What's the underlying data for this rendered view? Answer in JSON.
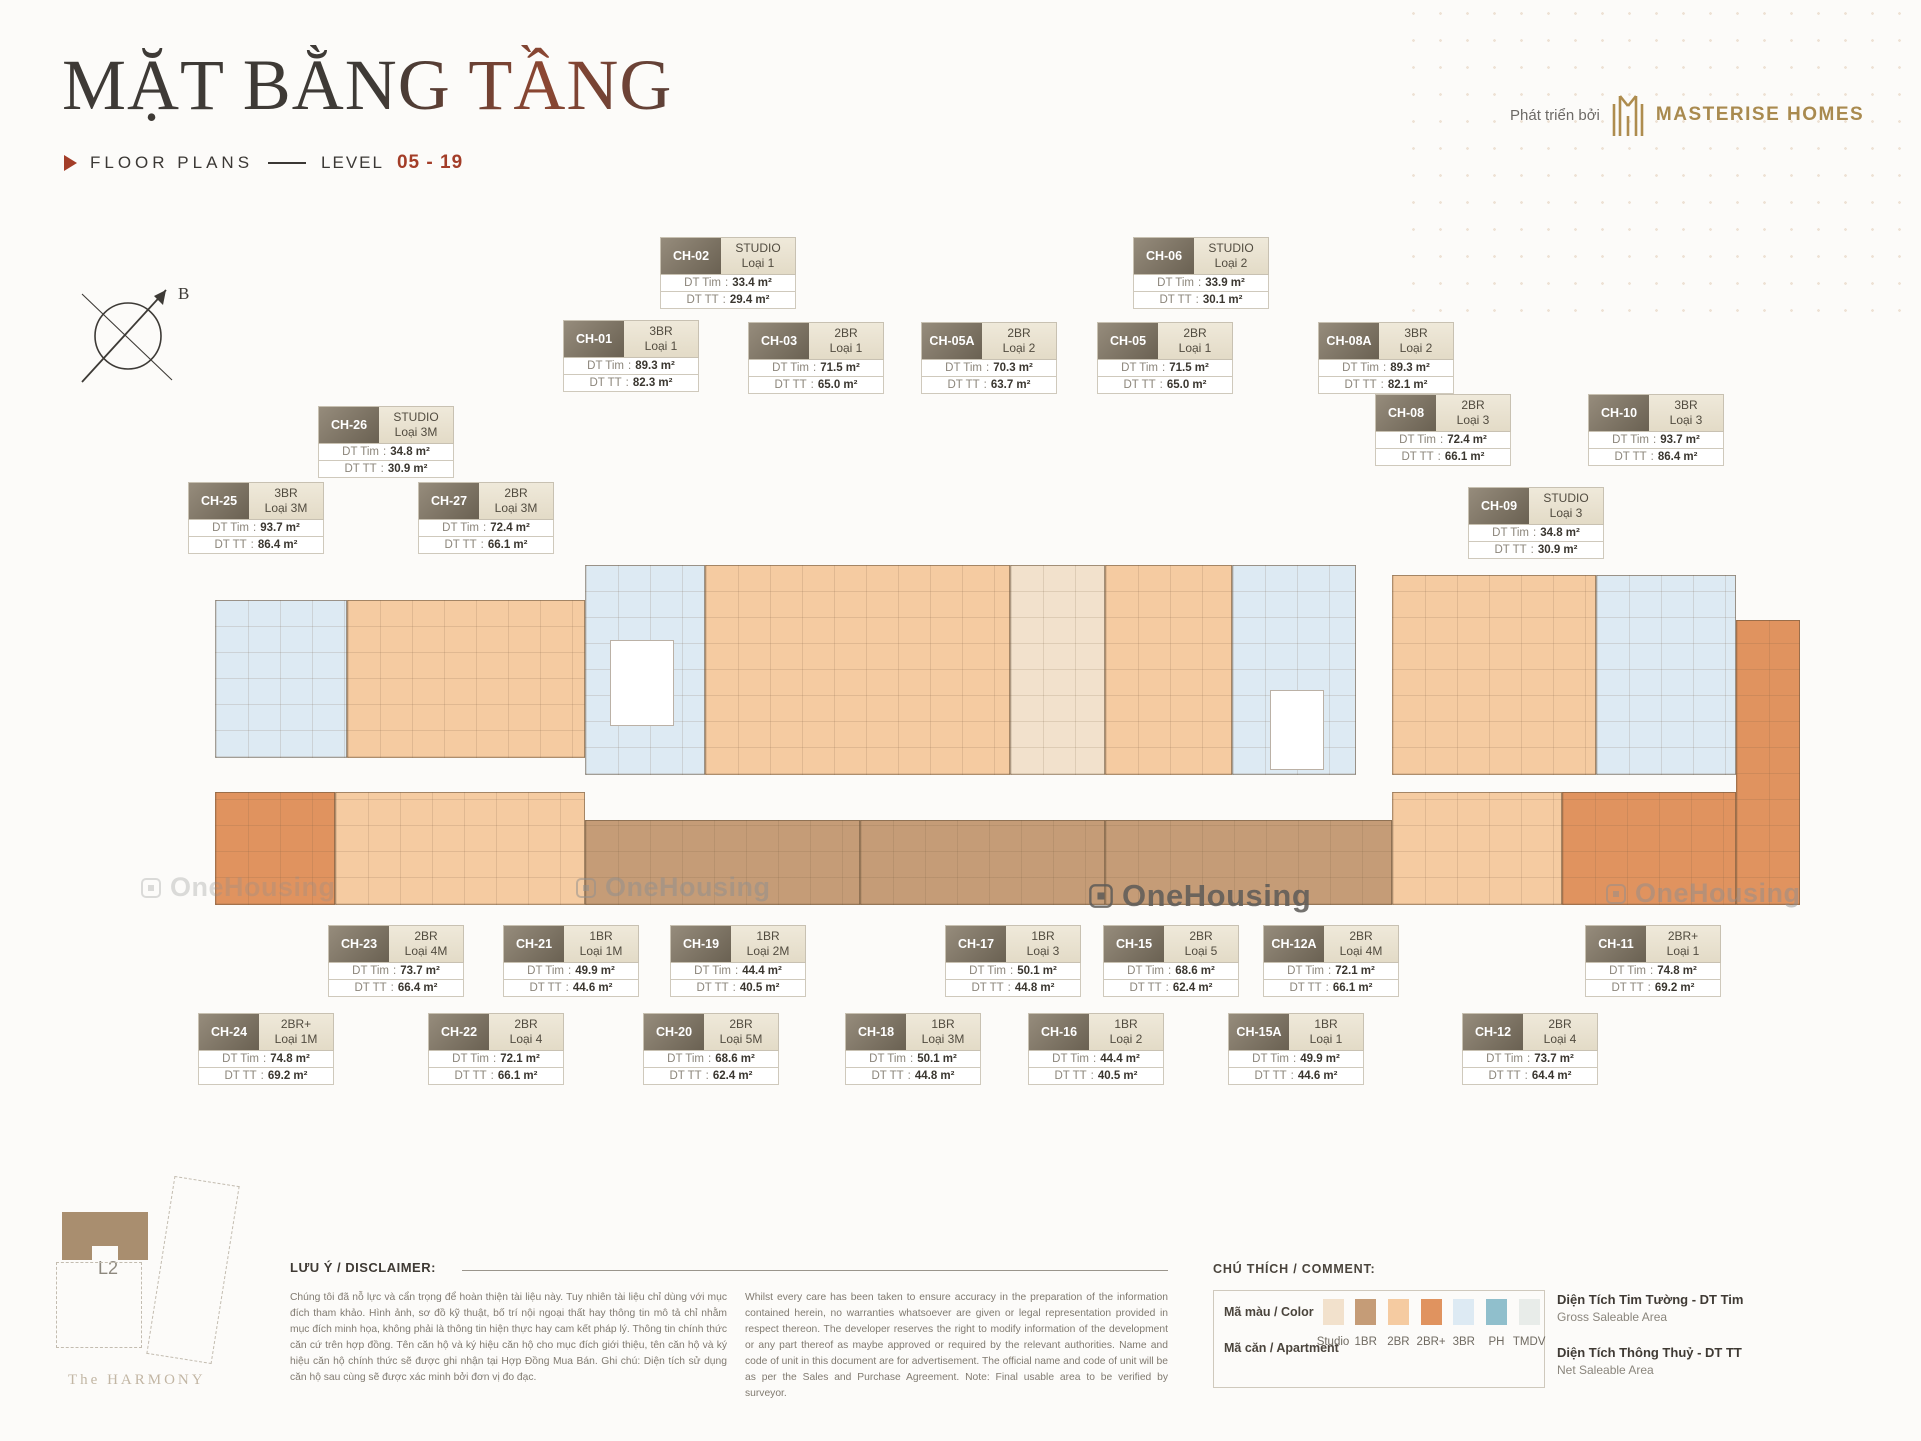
{
  "header": {
    "title": "MẶT BẰNG TẦNG",
    "subtitle_label": "FLOOR PLANS",
    "level_label": "LEVEL",
    "level_value": "05 - 19",
    "developer_prefix": "Phát triển bởi",
    "developer_name": "MASTERISE HOMES"
  },
  "compass": {
    "north_label": "B"
  },
  "watermark": {
    "text": "OneHousing"
  },
  "labels": {
    "dt_tim": "DT Tim",
    "dt_tt": "DT TT"
  },
  "units": [
    {
      "code": "CH-02",
      "type": "STUDIO",
      "variant": "Loại 1",
      "dt_tim": "33.4 m²",
      "dt_tt": "29.4 m²"
    },
    {
      "code": "CH-06",
      "type": "STUDIO",
      "variant": "Loại 2",
      "dt_tim": "33.9 m²",
      "dt_tt": "30.1 m²"
    },
    {
      "code": "CH-01",
      "type": "3BR",
      "variant": "Loại 1",
      "dt_tim": "89.3 m²",
      "dt_tt": "82.3 m²"
    },
    {
      "code": "CH-03",
      "type": "2BR",
      "variant": "Loại 1",
      "dt_tim": "71.5 m²",
      "dt_tt": "65.0 m²"
    },
    {
      "code": "CH-05A",
      "type": "2BR",
      "variant": "Loại 2",
      "dt_tim": "70.3 m²",
      "dt_tt": "63.7 m²"
    },
    {
      "code": "CH-05",
      "type": "2BR",
      "variant": "Loại 1",
      "dt_tim": "71.5 m²",
      "dt_tt": "65.0 m²"
    },
    {
      "code": "CH-08A",
      "type": "3BR",
      "variant": "Loại 2",
      "dt_tim": "89.3 m²",
      "dt_tt": "82.1 m²"
    },
    {
      "code": "CH-08",
      "type": "2BR",
      "variant": "Loại 3",
      "dt_tim": "72.4 m²",
      "dt_tt": "66.1 m²"
    },
    {
      "code": "CH-10",
      "type": "3BR",
      "variant": "Loại 3",
      "dt_tim": "93.7 m²",
      "dt_tt": "86.4 m²"
    },
    {
      "code": "CH-26",
      "type": "STUDIO",
      "variant": "Loại 3M",
      "dt_tim": "34.8 m²",
      "dt_tt": "30.9 m²"
    },
    {
      "code": "CH-25",
      "type": "3BR",
      "variant": "Loại 3M",
      "dt_tim": "93.7 m²",
      "dt_tt": "86.4 m²"
    },
    {
      "code": "CH-27",
      "type": "2BR",
      "variant": "Loại 3M",
      "dt_tim": "72.4 m²",
      "dt_tt": "66.1 m²"
    },
    {
      "code": "CH-09",
      "type": "STUDIO",
      "variant": "Loại 3",
      "dt_tim": "34.8 m²",
      "dt_tt": "30.9 m²"
    },
    {
      "code": "CH-23",
      "type": "2BR",
      "variant": "Loại 4M",
      "dt_tim": "73.7 m²",
      "dt_tt": "66.4 m²"
    },
    {
      "code": "CH-21",
      "type": "1BR",
      "variant": "Loại 1M",
      "dt_tim": "49.9 m²",
      "dt_tt": "44.6 m²"
    },
    {
      "code": "CH-19",
      "type": "1BR",
      "variant": "Loại 2M",
      "dt_tim": "44.4 m²",
      "dt_tt": "40.5 m²"
    },
    {
      "code": "CH-17",
      "type": "1BR",
      "variant": "Loại 3",
      "dt_tim": "50.1 m²",
      "dt_tt": "44.8 m²"
    },
    {
      "code": "CH-15",
      "type": "2BR",
      "variant": "Loại 5",
      "dt_tim": "68.6 m²",
      "dt_tt": "62.4 m²"
    },
    {
      "code": "CH-12A",
      "type": "2BR",
      "variant": "Loại 4M",
      "dt_tim": "72.1 m²",
      "dt_tt": "66.1 m²"
    },
    {
      "code": "CH-11",
      "type": "2BR+",
      "variant": "Loại 1",
      "dt_tim": "74.8 m²",
      "dt_tt": "69.2 m²"
    },
    {
      "code": "CH-24",
      "type": "2BR+",
      "variant": "Loại 1M",
      "dt_tim": "74.8 m²",
      "dt_tt": "69.2 m²"
    },
    {
      "code": "CH-22",
      "type": "2BR",
      "variant": "Loại 4",
      "dt_tim": "72.1 m²",
      "dt_tt": "66.1 m²"
    },
    {
      "code": "CH-20",
      "type": "2BR",
      "variant": "Loại 5M",
      "dt_tim": "68.6 m²",
      "dt_tt": "62.4 m²"
    },
    {
      "code": "CH-18",
      "type": "1BR",
      "variant": "Loại 3M",
      "dt_tim": "50.1 m²",
      "dt_tt": "44.8 m²"
    },
    {
      "code": "CH-16",
      "type": "1BR",
      "variant": "Loại 2",
      "dt_tim": "44.4 m²",
      "dt_tt": "40.5 m²"
    },
    {
      "code": "CH-15A",
      "type": "1BR",
      "variant": "Loại 1",
      "dt_tim": "49.9 m²",
      "dt_tt": "44.6 m²"
    },
    {
      "code": "CH-12",
      "type": "2BR",
      "variant": "Loại 4",
      "dt_tim": "73.7 m²",
      "dt_tt": "64.4 m²"
    }
  ],
  "legend": {
    "heading": "CHÚ THÍCH / COMMENT:",
    "color_row_label": "Mã màu / Color",
    "apartment_row_label": "Mã căn / Apartment",
    "items": [
      {
        "label": "Studio",
        "color": "#F2E1CC"
      },
      {
        "label": "1BR",
        "color": "#C59C77"
      },
      {
        "label": "2BR",
        "color": "#F5CBA1"
      },
      {
        "label": "2BR+",
        "color": "#E0935F"
      },
      {
        "label": "3BR",
        "color": "#DDEAF3"
      },
      {
        "label": "PH",
        "color": "#90BFCC"
      },
      {
        "label": "TMDV",
        "color": "#E8ECE9"
      }
    ],
    "gross": {
      "title": "Diện Tích Tim Tường - DT Tim",
      "subtitle": "Gross Saleable Area"
    },
    "net": {
      "title": "Diện Tích Thông Thuỷ - DT TT",
      "subtitle": "Net Saleable Area"
    }
  },
  "disclaimer": {
    "heading": "LƯU Ý / DISCLAIMER:",
    "vietnamese": "Chúng tôi đã nỗ lực và cẩn trọng để hoàn thiện tài liệu này. Tuy nhiên tài liệu chỉ dùng với mục đích tham khảo. Hình ảnh, sơ đồ kỹ thuật, bố trí nội ngoại thất hay thông tin mô tả chỉ nhằm mục đích minh họa, không phải là thông tin hiện thực hay cam kết pháp lý. Thông tin chính thức căn cứ trên hợp đồng. Tên căn hộ và ký hiệu căn hộ cho mục đích giới thiệu, tên căn hộ và ký hiệu căn hộ chính thức sẽ được ghi nhận tại Hợp Đồng Mua Bán. Ghi chú: Diện tích sử dụng căn hộ sau cùng sẽ được xác minh bởi đơn vị đo đạc.",
    "english": "Whilst every care has been taken to ensure accuracy in the preparation of the information contained herein, no warranties whatsoever are given or legal representation provided in respect thereon. The developer reserves the right to modify information of the development or any part thereof as maybe approved or required by the relevant authorities. Name and code of unit in this document are for advertisement. The official name and code of unit will be as per the Sales and Purchase Agreement. Note: Final usable area to be verified by surveyor."
  },
  "sitemap": {
    "building_label": "L2",
    "project_name": "The HARMONY"
  }
}
